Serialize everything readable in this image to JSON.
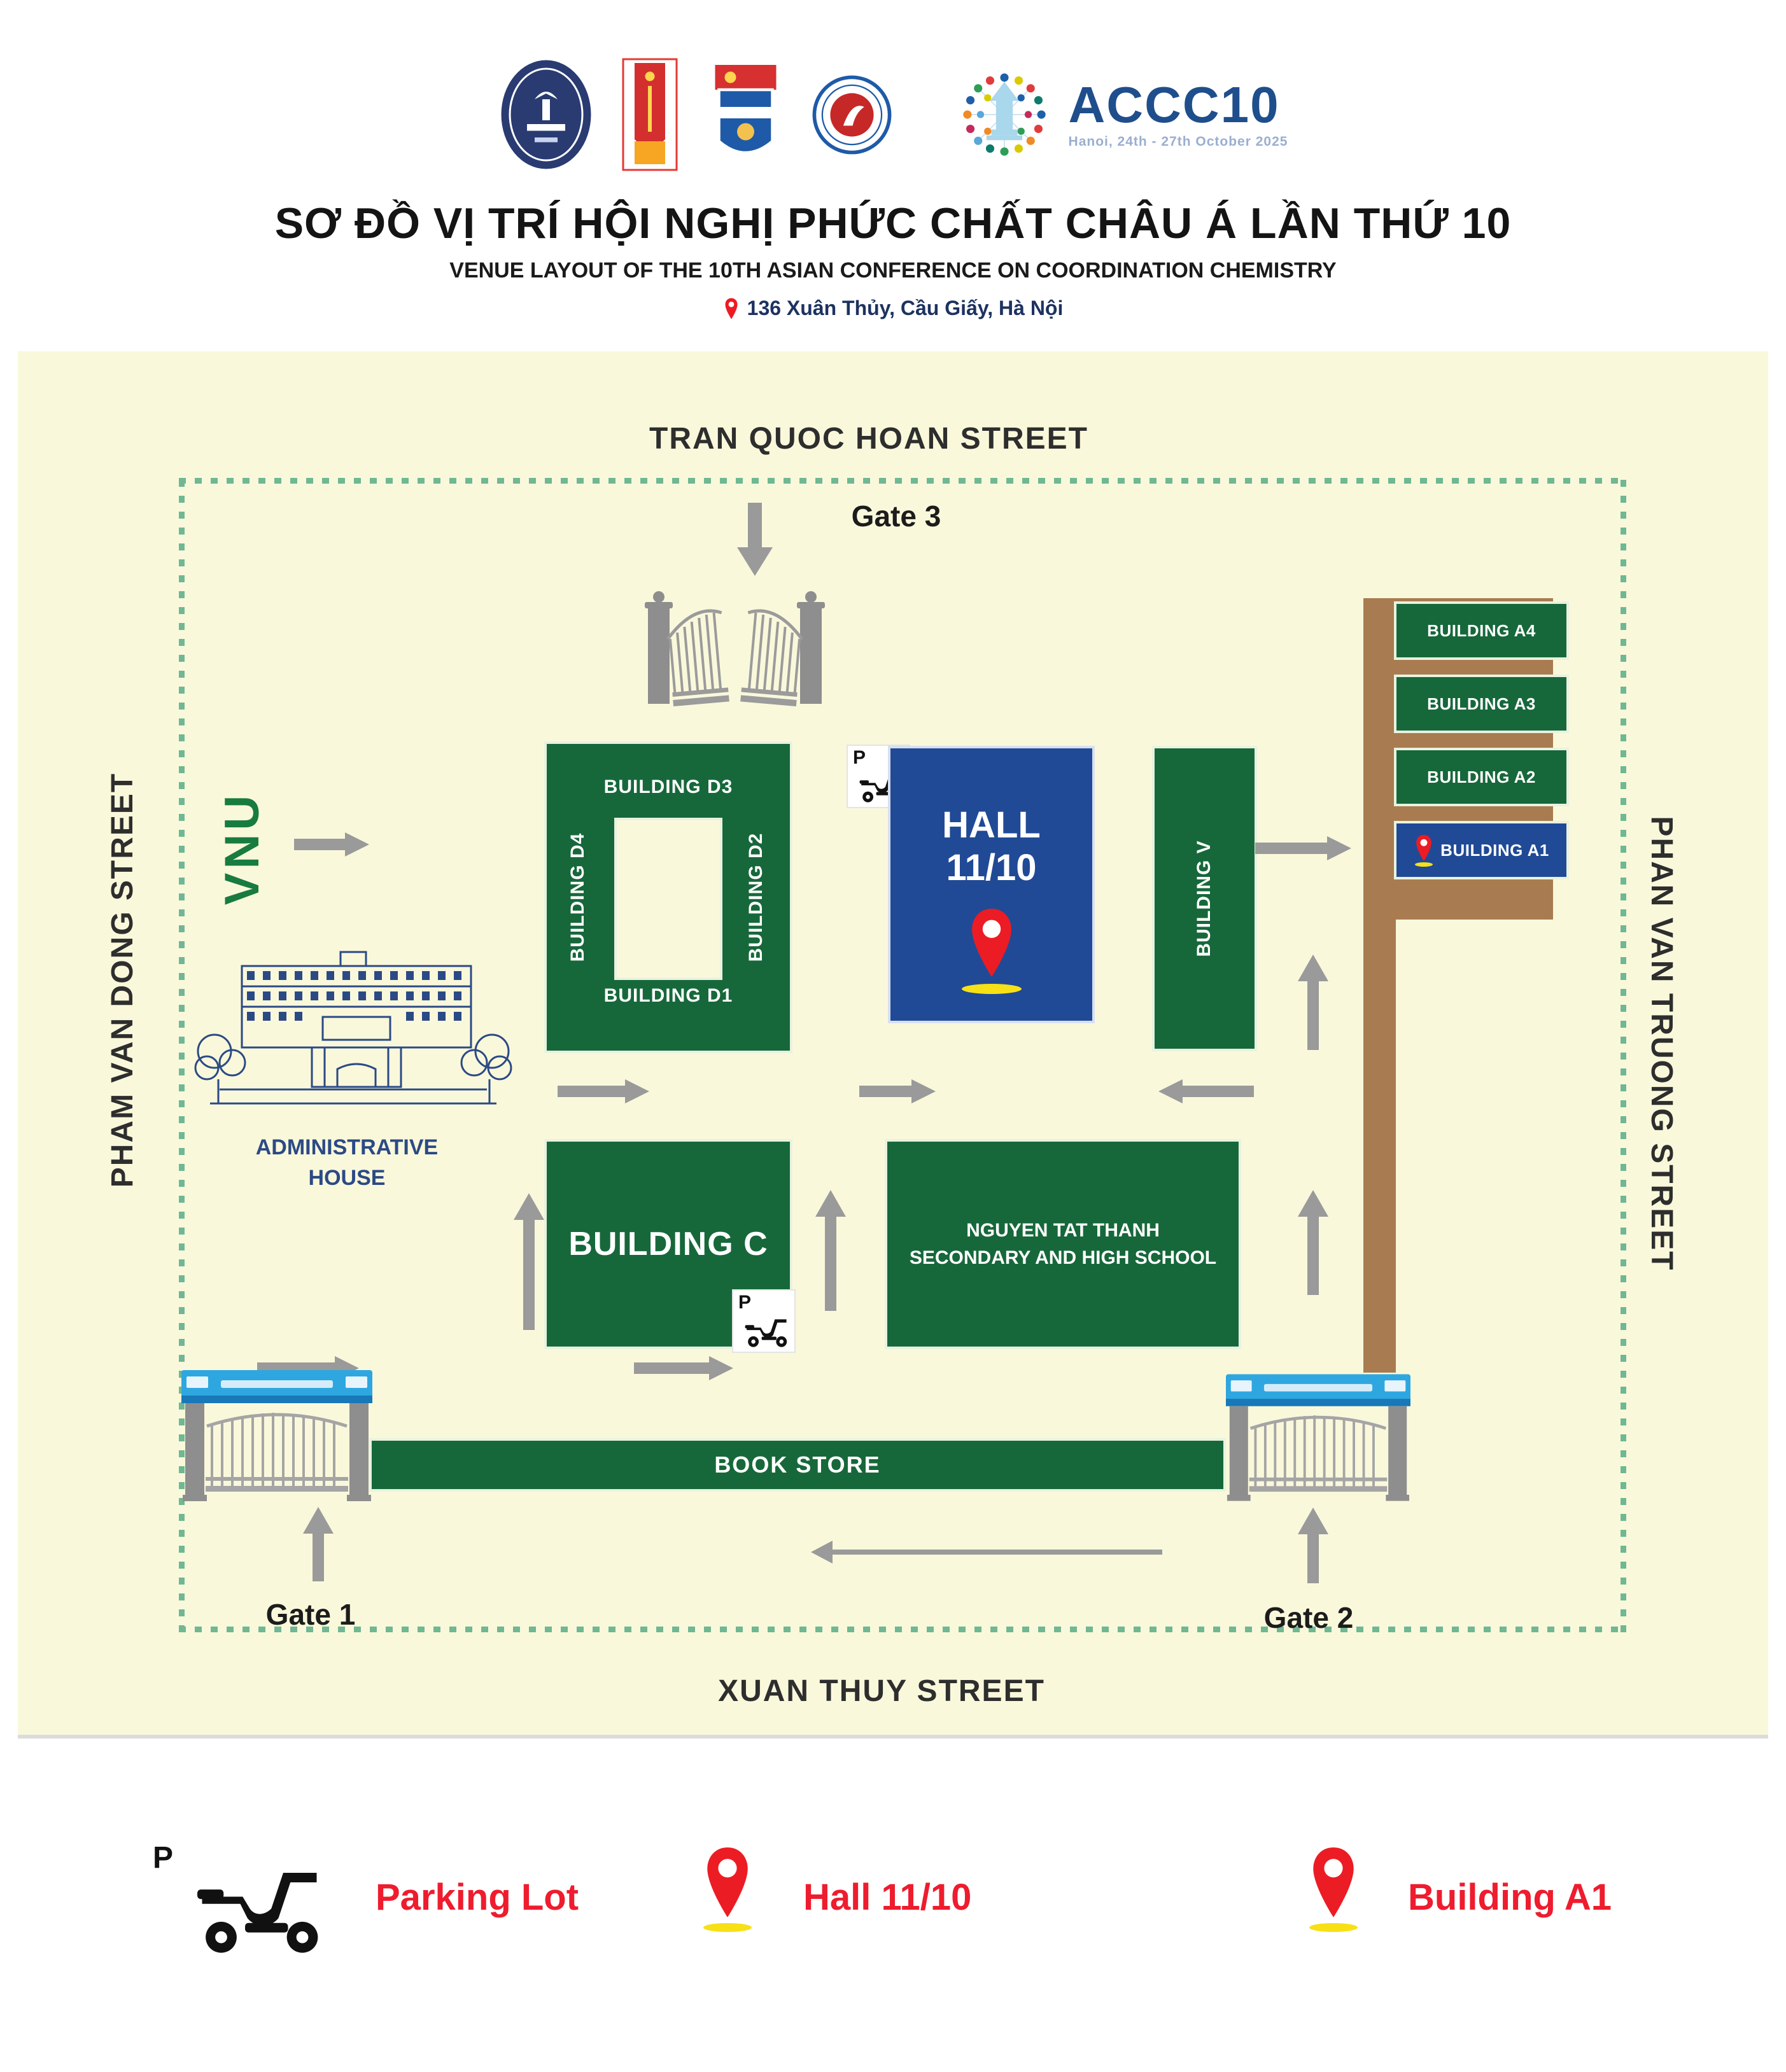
{
  "header": {
    "logos": [
      "vnu-university-logo",
      "red-banner-logo",
      "flag-shield-logo",
      "round-seal-logo"
    ],
    "accc10": {
      "wordmark": "ACCC10",
      "tagline": "Hanoi, 24th - 27th October 2025"
    },
    "title": "SƠ ĐỒ VỊ TRÍ HỘI NGHỊ PHỨC CHẤT CHÂU Á LẦN THỨ 10",
    "subtitle": "VENUE LAYOUT OF THE 10TH ASIAN CONFERENCE ON COORDINATION CHEMISTRY",
    "address": "136 Xuân Thủy, Cầu Giấy, Hà Nội"
  },
  "map": {
    "streets": {
      "top": "TRAN QUOC HOAN STREET",
      "left": "PHAM VAN DONG STREET",
      "right": "PHAN VAN TRUONG STREET",
      "bottom": "XUAN THUY STREET"
    },
    "gates": {
      "gate1": "Gate 1",
      "gate2": "Gate 2",
      "gate3": "Gate 3"
    },
    "vnu": "VNU",
    "parking_p": "P",
    "buildings": {
      "d3": "BUILDING D3",
      "d4": "BUILDING D4",
      "d2": "BUILDING D2",
      "d1": "BUILDING D1",
      "hall": {
        "line1": "HALL",
        "line2": "11/10"
      },
      "v": "BUILDING V",
      "a4": "BUILDING A4",
      "a3": "BUILDING A3",
      "a2": "BUILDING A2",
      "a1": "BUILDING A1",
      "admin": {
        "line1": "ADMINISTRATIVE",
        "line2": "HOUSE"
      },
      "c": "BUILDING C",
      "school": {
        "line1": "NGUYEN TAT THANH",
        "line2": "SECONDARY AND HIGH SCHOOL"
      },
      "bookstore": "BOOK STORE"
    }
  },
  "legend": {
    "parking": {
      "p": "P",
      "label": "Parking Lot",
      "icon": "motorbike-icon"
    },
    "hall": {
      "label": "Hall 11/10",
      "icon": "map-pin-icon"
    },
    "a1": {
      "label": "Building A1",
      "icon": "map-pin-icon"
    }
  },
  "colors": {
    "map_bg": "#FAF8DB",
    "building_green": "#16683A",
    "hall_blue": "#204A96",
    "road_brown": "#A87C50",
    "arrow_gray": "#9A9A9A",
    "dash_green": "#6FB893",
    "pin_red": "#EC1C24",
    "pin_shadow_yellow": "#F7E016",
    "legend_red": "#EE1C2E",
    "vnu_green": "#187B40",
    "admin_navy": "#2B4A85",
    "accc_navy": "#1F4E8C",
    "banner_blue": "#2EA7E0",
    "gate_gray": "#8E8E8E"
  }
}
